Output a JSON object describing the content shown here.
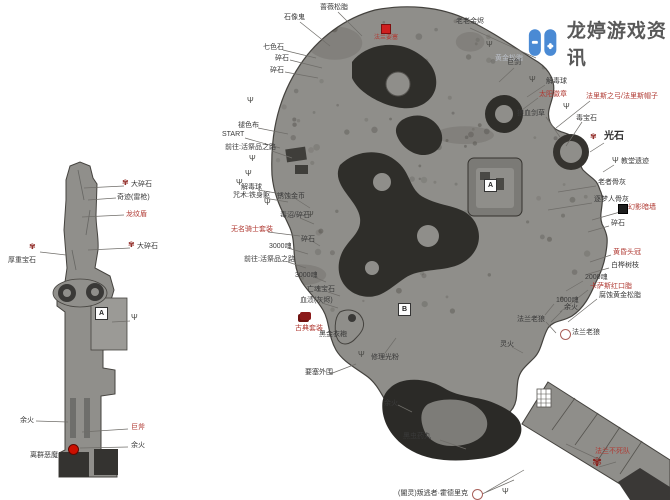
{
  "watermark": {
    "title": "龙婷游戏资讯"
  },
  "palette": {
    "red": "#b03a33",
    "ink": "#3a3a3a",
    "faint": "#b9bec7",
    "map": "#8f8e8a",
    "dark": "#2f2e2a",
    "logo_blue": "#4a8ad4"
  },
  "labels": [
    {
      "text": "大碎石",
      "x": 131,
      "y": 181,
      "leader": [
        124,
        186,
        84,
        188
      ]
    },
    {
      "text": "奇迹(雷枪)",
      "x": 117,
      "y": 194,
      "leader": [
        116,
        198,
        88,
        200
      ]
    },
    {
      "text": "龙纹盾",
      "x": 126,
      "y": 211,
      "color": "red",
      "leader": [
        124,
        215,
        82,
        217
      ]
    },
    {
      "text": "大碎石",
      "x": 137,
      "y": 243,
      "leader": [
        130,
        248,
        88,
        250
      ]
    },
    {
      "text": "厚重宝石",
      "x": 8,
      "y": 257,
      "leader": [
        40,
        252,
        66,
        255
      ]
    },
    {
      "text": "余火",
      "x": 20,
      "y": 417,
      "leader": [
        36,
        421,
        68,
        422
      ]
    },
    {
      "text": "巨斧",
      "x": 131,
      "y": 424,
      "color": "red",
      "leader": [
        128,
        429,
        82,
        432
      ]
    },
    {
      "text": "余火",
      "x": 131,
      "y": 442,
      "leader": [
        128,
        447,
        80,
        448
      ]
    },
    {
      "text": "离群恶魔",
      "x": 30,
      "y": 452
    },
    {
      "text": "石像鬼",
      "x": 284,
      "y": 14,
      "leader": [
        300,
        22,
        330,
        46
      ]
    },
    {
      "text": "蔷薇松脂",
      "x": 320,
      "y": 4,
      "leader": [
        338,
        12,
        362,
        36
      ]
    },
    {
      "text": "法兰要塞",
      "x": 374,
      "y": 35,
      "color": "red",
      "size": 6
    },
    {
      "text": "老老余烬",
      "x": 456,
      "y": 18,
      "leader": [
        470,
        28,
        536,
        58
      ]
    },
    {
      "text": "黄金松脂",
      "x": 495,
      "y": 55,
      "color": "faint"
    },
    {
      "text": "巨剑",
      "x": 507,
      "y": 59,
      "leader": [
        514,
        68,
        499,
        82
      ]
    },
    {
      "text": "解毒球",
      "x": 546,
      "y": 78,
      "leader": [
        545,
        85,
        527,
        97
      ]
    },
    {
      "text": "太阳徽章",
      "x": 539,
      "y": 91,
      "color": "red",
      "leader": [
        538,
        98,
        522,
        110
      ]
    },
    {
      "text": "法里斯之弓/法里斯帽子",
      "x": 586,
      "y": 93,
      "color": "red",
      "leader": [
        590,
        101,
        556,
        128
      ]
    },
    {
      "text": "狼血剑草",
      "x": 517,
      "y": 110,
      "leader": [
        546,
        117,
        560,
        137
      ]
    },
    {
      "text": "毒宝石",
      "x": 576,
      "y": 115,
      "leader": [
        582,
        122,
        566,
        146
      ]
    },
    {
      "text": "光石",
      "x": 604,
      "y": 132,
      "size": 10,
      "leader": [
        604,
        143,
        590,
        152
      ]
    },
    {
      "text": "教堂遗迹",
      "x": 621,
      "y": 158,
      "leader": [
        614,
        165,
        603,
        172
      ]
    },
    {
      "text": "老者骨灰",
      "x": 598,
      "y": 179,
      "leader": [
        596,
        186,
        558,
        192
      ]
    },
    {
      "text": "逐梦人骨灰",
      "x": 594,
      "y": 196,
      "leader": [
        592,
        203,
        548,
        210
      ]
    },
    {
      "text": "幻影暗墙",
      "x": 628,
      "y": 204,
      "color": "red",
      "leader": [
        620,
        212,
        592,
        220
      ]
    },
    {
      "text": "碎石",
      "x": 611,
      "y": 220,
      "leader": [
        609,
        226,
        588,
        232
      ]
    },
    {
      "text": "黄昏头冠",
      "x": 613,
      "y": 249,
      "color": "red",
      "leader": [
        611,
        255,
        590,
        262
      ]
    },
    {
      "text": "白桦树枝",
      "x": 611,
      "y": 262,
      "leader": [
        609,
        268,
        588,
        274
      ]
    },
    {
      "text": "2000魂",
      "x": 585,
      "y": 274,
      "leader": [
        583,
        281,
        566,
        291
      ]
    },
    {
      "text": "卡萨斯红口脂",
      "x": 590,
      "y": 283,
      "color": "red",
      "leader": [
        588,
        290,
        560,
        312
      ]
    },
    {
      "text": "腐蚀黄金松脂",
      "x": 599,
      "y": 292,
      "leader": [
        597,
        299,
        568,
        322
      ]
    },
    {
      "text": "1000魂",
      "x": 556,
      "y": 297,
      "leader": [
        554,
        304,
        545,
        315
      ]
    },
    {
      "text": "余火",
      "x": 564,
      "y": 304,
      "leader": [
        562,
        311,
        551,
        322
      ]
    },
    {
      "text": "法兰老狼",
      "x": 517,
      "y": 316,
      "leader": [
        546,
        322,
        556,
        333
      ]
    },
    {
      "text": "法兰老狼",
      "x": 572,
      "y": 329
    },
    {
      "text": "灵火",
      "x": 500,
      "y": 341,
      "leader": [
        512,
        347,
        523,
        353
      ]
    },
    {
      "text": "余火",
      "x": 384,
      "y": 400,
      "leader": [
        398,
        405,
        412,
        412
      ]
    },
    {
      "text": "黑虫药丸",
      "x": 403,
      "y": 433,
      "leader": [
        440,
        440,
        466,
        449
      ]
    },
    {
      "text": "法兰不死队",
      "x": 595,
      "y": 448,
      "color": "red",
      "leader": [
        596,
        458,
        566,
        444
      ]
    },
    {
      "text": "(闇灵)叛逃者·霍德里克",
      "x": 398,
      "y": 490,
      "leader": [
        482,
        494,
        514,
        480
      ]
    },
    {
      "text": "七色石",
      "x": 263,
      "y": 44,
      "leader": [
        283,
        50,
        316,
        58
      ]
    },
    {
      "text": "碎石",
      "x": 275,
      "y": 55,
      "leader": [
        290,
        60,
        322,
        68
      ]
    },
    {
      "text": "碎石",
      "x": 270,
      "y": 67,
      "leader": [
        285,
        72,
        318,
        78
      ]
    },
    {
      "text": "褪色布",
      "x": 238,
      "y": 122,
      "leader": [
        258,
        128,
        288,
        134
      ]
    },
    {
      "text": "START",
      "x": 222,
      "y": 131,
      "leader": [
        245,
        138,
        280,
        148
      ]
    },
    {
      "text": "前往:活祭品之路",
      "x": 225,
      "y": 144,
      "leader": [
        272,
        151,
        292,
        158
      ]
    },
    {
      "text": "解毒球",
      "x": 241,
      "y": 184,
      "leader": [
        258,
        190,
        282,
        194
      ]
    },
    {
      "text": "咒术:铁身躯",
      "x": 233,
      "y": 192,
      "leader": [
        264,
        198,
        288,
        202
      ]
    },
    {
      "text": "锈蚀金币",
      "x": 277,
      "y": 193,
      "leader": [
        296,
        199,
        310,
        208
      ]
    },
    {
      "text": "毒沼/碎石",
      "x": 280,
      "y": 212,
      "leader": [
        300,
        218,
        314,
        224
      ]
    },
    {
      "text": "无名骑士套装",
      "x": 231,
      "y": 226,
      "color": "red",
      "leader": [
        268,
        232,
        300,
        236
      ]
    },
    {
      "text": "碎石",
      "x": 301,
      "y": 236,
      "leader": [
        312,
        241,
        320,
        246
      ]
    },
    {
      "text": "3000魂",
      "x": 269,
      "y": 243,
      "leader": [
        288,
        248,
        308,
        254
      ]
    },
    {
      "text": "前往:活祭品之路",
      "x": 244,
      "y": 256,
      "leader": [
        288,
        262,
        306,
        268
      ]
    },
    {
      "text": "3000魂",
      "x": 295,
      "y": 272,
      "leader": [
        314,
        277,
        326,
        282
      ]
    },
    {
      "text": "亡魂宝石",
      "x": 307,
      "y": 286,
      "leader": [
        328,
        292,
        340,
        296
      ]
    },
    {
      "text": "血渍(灰烬)",
      "x": 300,
      "y": 297,
      "leader": [
        322,
        303,
        338,
        308
      ]
    },
    {
      "text": "古典套装",
      "x": 295,
      "y": 325,
      "color": "red"
    },
    {
      "text": "黑金衣袍",
      "x": 319,
      "y": 331,
      "leader": [
        340,
        336,
        347,
        333
      ]
    },
    {
      "text": "修理光粉",
      "x": 371,
      "y": 354,
      "leader": [
        385,
        353,
        396,
        338
      ]
    },
    {
      "text": "要塞外围",
      "x": 305,
      "y": 369,
      "leader": [
        330,
        374,
        356,
        364
      ]
    }
  ],
  "icons": [
    {
      "type": "moth",
      "x": 122,
      "y": 179
    },
    {
      "type": "moth",
      "x": 128,
      "y": 241
    },
    {
      "type": "moth",
      "x": 29,
      "y": 243
    },
    {
      "type": "moth",
      "x": 590,
      "y": 133
    },
    {
      "type": "moth",
      "x": 592,
      "y": 456,
      "big": true
    },
    {
      "type": "fork",
      "x": 486,
      "y": 41
    },
    {
      "type": "fork",
      "x": 529,
      "y": 76
    },
    {
      "type": "fork",
      "x": 563,
      "y": 103
    },
    {
      "type": "fork",
      "x": 612,
      "y": 157
    },
    {
      "type": "fork",
      "x": 247,
      "y": 97
    },
    {
      "type": "fork",
      "x": 249,
      "y": 155
    },
    {
      "type": "fork",
      "x": 245,
      "y": 170
    },
    {
      "type": "fork",
      "x": 236,
      "y": 179
    },
    {
      "type": "fork",
      "x": 264,
      "y": 199
    },
    {
      "type": "fork",
      "x": 307,
      "y": 211
    },
    {
      "type": "fork",
      "x": 358,
      "y": 351
    },
    {
      "type": "fork",
      "x": 502,
      "y": 488
    },
    {
      "type": "fork",
      "x": 131,
      "y": 314
    }
  ],
  "markers": [
    {
      "type": "refbox",
      "label": "A",
      "x": 95,
      "y": 307
    },
    {
      "type": "refbox",
      "label": "A",
      "x": 484,
      "y": 179
    },
    {
      "type": "refbox",
      "label": "B",
      "x": 398,
      "y": 303
    },
    {
      "type": "redsquare",
      "x": 381,
      "y": 24
    },
    {
      "type": "reddot",
      "x": 68,
      "y": 444
    },
    {
      "type": "circle",
      "x": 560,
      "y": 329
    },
    {
      "type": "circle",
      "x": 472,
      "y": 489
    },
    {
      "type": "darkbox",
      "x": 618,
      "y": 204
    },
    {
      "type": "cluster",
      "x": 300,
      "y": 312
    }
  ],
  "extra_lines": [
    [
      599,
      467,
      616,
      462
    ],
    [
      486,
      492,
      524,
      470
    ],
    [
      112,
      322,
      130,
      321
    ]
  ]
}
